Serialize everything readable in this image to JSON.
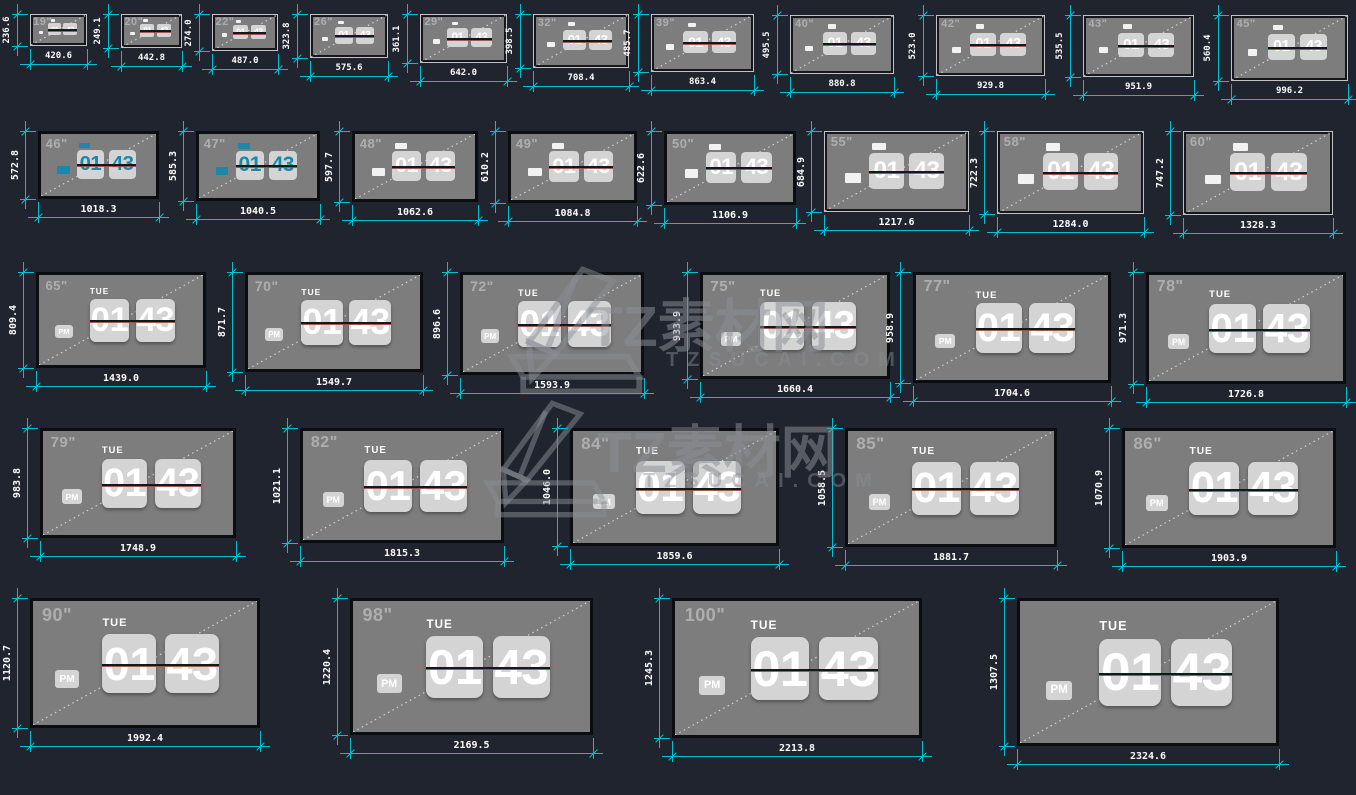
{
  "watermark": {
    "brand": "TZ素材网",
    "domain": "TZSUCAI.COM"
  },
  "clock": {
    "day": "TUE",
    "hour": "01",
    "minute": "43",
    "meridiem": "PM"
  },
  "colors": {
    "background": "#20242e",
    "dimension": "#00c0d4",
    "screen_fill": "#7d7d7d",
    "clock_card": "#d4d4d4",
    "clock_accent_blue": "#1b87aa",
    "divider_red": "#9c4a42"
  },
  "screens": [
    {
      "label": "19\"",
      "width": "420.6",
      "height": "236.6",
      "style": "mini",
      "accent": "white",
      "frame": "light"
    },
    {
      "label": "20\"",
      "width": "442.8",
      "height": "249.1",
      "style": "mini",
      "accent": "white",
      "frame": "light"
    },
    {
      "label": "22\"",
      "width": "487.0",
      "height": "274.0",
      "style": "mini",
      "accent": "white",
      "frame": "light"
    },
    {
      "label": "26\"",
      "width": "575.6",
      "height": "323.8",
      "style": "mini",
      "accent": "white",
      "frame": "light"
    },
    {
      "label": "29\"",
      "width": "642.0",
      "height": "361.1",
      "style": "mini",
      "accent": "white",
      "frame": "light"
    },
    {
      "label": "32\"",
      "width": "708.4",
      "height": "398.5",
      "style": "mini",
      "accent": "white",
      "frame": "light"
    },
    {
      "label": "39\"",
      "width": "863.4",
      "height": "485.7",
      "style": "mini",
      "accent": "white",
      "frame": "light"
    },
    {
      "label": "40\"",
      "width": "880.8",
      "height": "495.5",
      "style": "mini",
      "accent": "white",
      "frame": "light"
    },
    {
      "label": "42\"",
      "width": "929.8",
      "height": "523.0",
      "style": "mini",
      "accent": "white",
      "frame": "light"
    },
    {
      "label": "43\"",
      "width": "951.9",
      "height": "535.5",
      "style": "mini",
      "accent": "white",
      "frame": "light"
    },
    {
      "label": "45\"",
      "width": "996.2",
      "height": "560.4",
      "style": "mini",
      "accent": "white",
      "frame": "light"
    },
    {
      "label": "46\"",
      "width": "1018.3",
      "height": "572.8",
      "style": "small",
      "accent": "blue",
      "frame": "dark"
    },
    {
      "label": "47\"",
      "width": "1040.5",
      "height": "585.3",
      "style": "small",
      "accent": "blue",
      "frame": "dark"
    },
    {
      "label": "48\"",
      "width": "1062.6",
      "height": "597.7",
      "style": "small",
      "accent": "white",
      "frame": "dark"
    },
    {
      "label": "49\"",
      "width": "1084.8",
      "height": "610.2",
      "style": "small",
      "accent": "white",
      "frame": "dark"
    },
    {
      "label": "50\"",
      "width": "1106.9",
      "height": "622.6",
      "style": "small",
      "accent": "white",
      "frame": "dark"
    },
    {
      "label": "55\"",
      "width": "1217.6",
      "height": "684.9",
      "style": "small",
      "accent": "white",
      "frame": "light"
    },
    {
      "label": "58\"",
      "width": "1284.0",
      "height": "722.3",
      "style": "small",
      "accent": "white",
      "frame": "light"
    },
    {
      "label": "60\"",
      "width": "1328.3",
      "height": "747.2",
      "style": "small",
      "accent": "white",
      "frame": "light"
    },
    {
      "label": "65\"",
      "width": "1439.0",
      "height": "809.4",
      "style": "full",
      "accent": "white",
      "frame": "dark"
    },
    {
      "label": "70\"",
      "width": "1549.7",
      "height": "871.7",
      "style": "full",
      "accent": "white",
      "frame": "dark"
    },
    {
      "label": "72\"",
      "width": "1593.9",
      "height": "896.6",
      "style": "full",
      "accent": "white",
      "frame": "dark"
    },
    {
      "label": "75\"",
      "width": "1660.4",
      "height": "933.9",
      "style": "full",
      "accent": "white",
      "frame": "dark"
    },
    {
      "label": "77\"",
      "width": "1704.6",
      "height": "958.9",
      "style": "full",
      "accent": "white",
      "frame": "dark"
    },
    {
      "label": "78\"",
      "width": "1726.8",
      "height": "971.3",
      "style": "full",
      "accent": "white",
      "frame": "dark"
    },
    {
      "label": "79\"",
      "width": "1748.9",
      "height": "983.8",
      "style": "full",
      "accent": "white",
      "frame": "dark"
    },
    {
      "label": "82\"",
      "width": "1815.3",
      "height": "1021.1",
      "style": "full",
      "accent": "white",
      "frame": "dark"
    },
    {
      "label": "84\"",
      "width": "1859.6",
      "height": "1046.0",
      "style": "full",
      "accent": "white",
      "frame": "dark"
    },
    {
      "label": "85\"",
      "width": "1881.7",
      "height": "1058.5",
      "style": "full",
      "accent": "white",
      "frame": "dark"
    },
    {
      "label": "86\"",
      "width": "1903.9",
      "height": "1070.9",
      "style": "full",
      "accent": "white",
      "frame": "dark"
    },
    {
      "label": "90\"",
      "width": "1992.4",
      "height": "1120.7",
      "style": "full",
      "accent": "white",
      "frame": "dark"
    },
    {
      "label": "98\"",
      "width": "2169.5",
      "height": "1220.4",
      "style": "full",
      "accent": "white",
      "frame": "dark"
    },
    {
      "label": "100\"",
      "width": "2213.8",
      "height": "1245.3",
      "style": "full",
      "accent": "white",
      "frame": "dark"
    },
    {
      "label": "",
      "width": "2324.6",
      "height": "1307.5",
      "style": "full",
      "accent": "white",
      "frame": "dark"
    }
  ]
}
